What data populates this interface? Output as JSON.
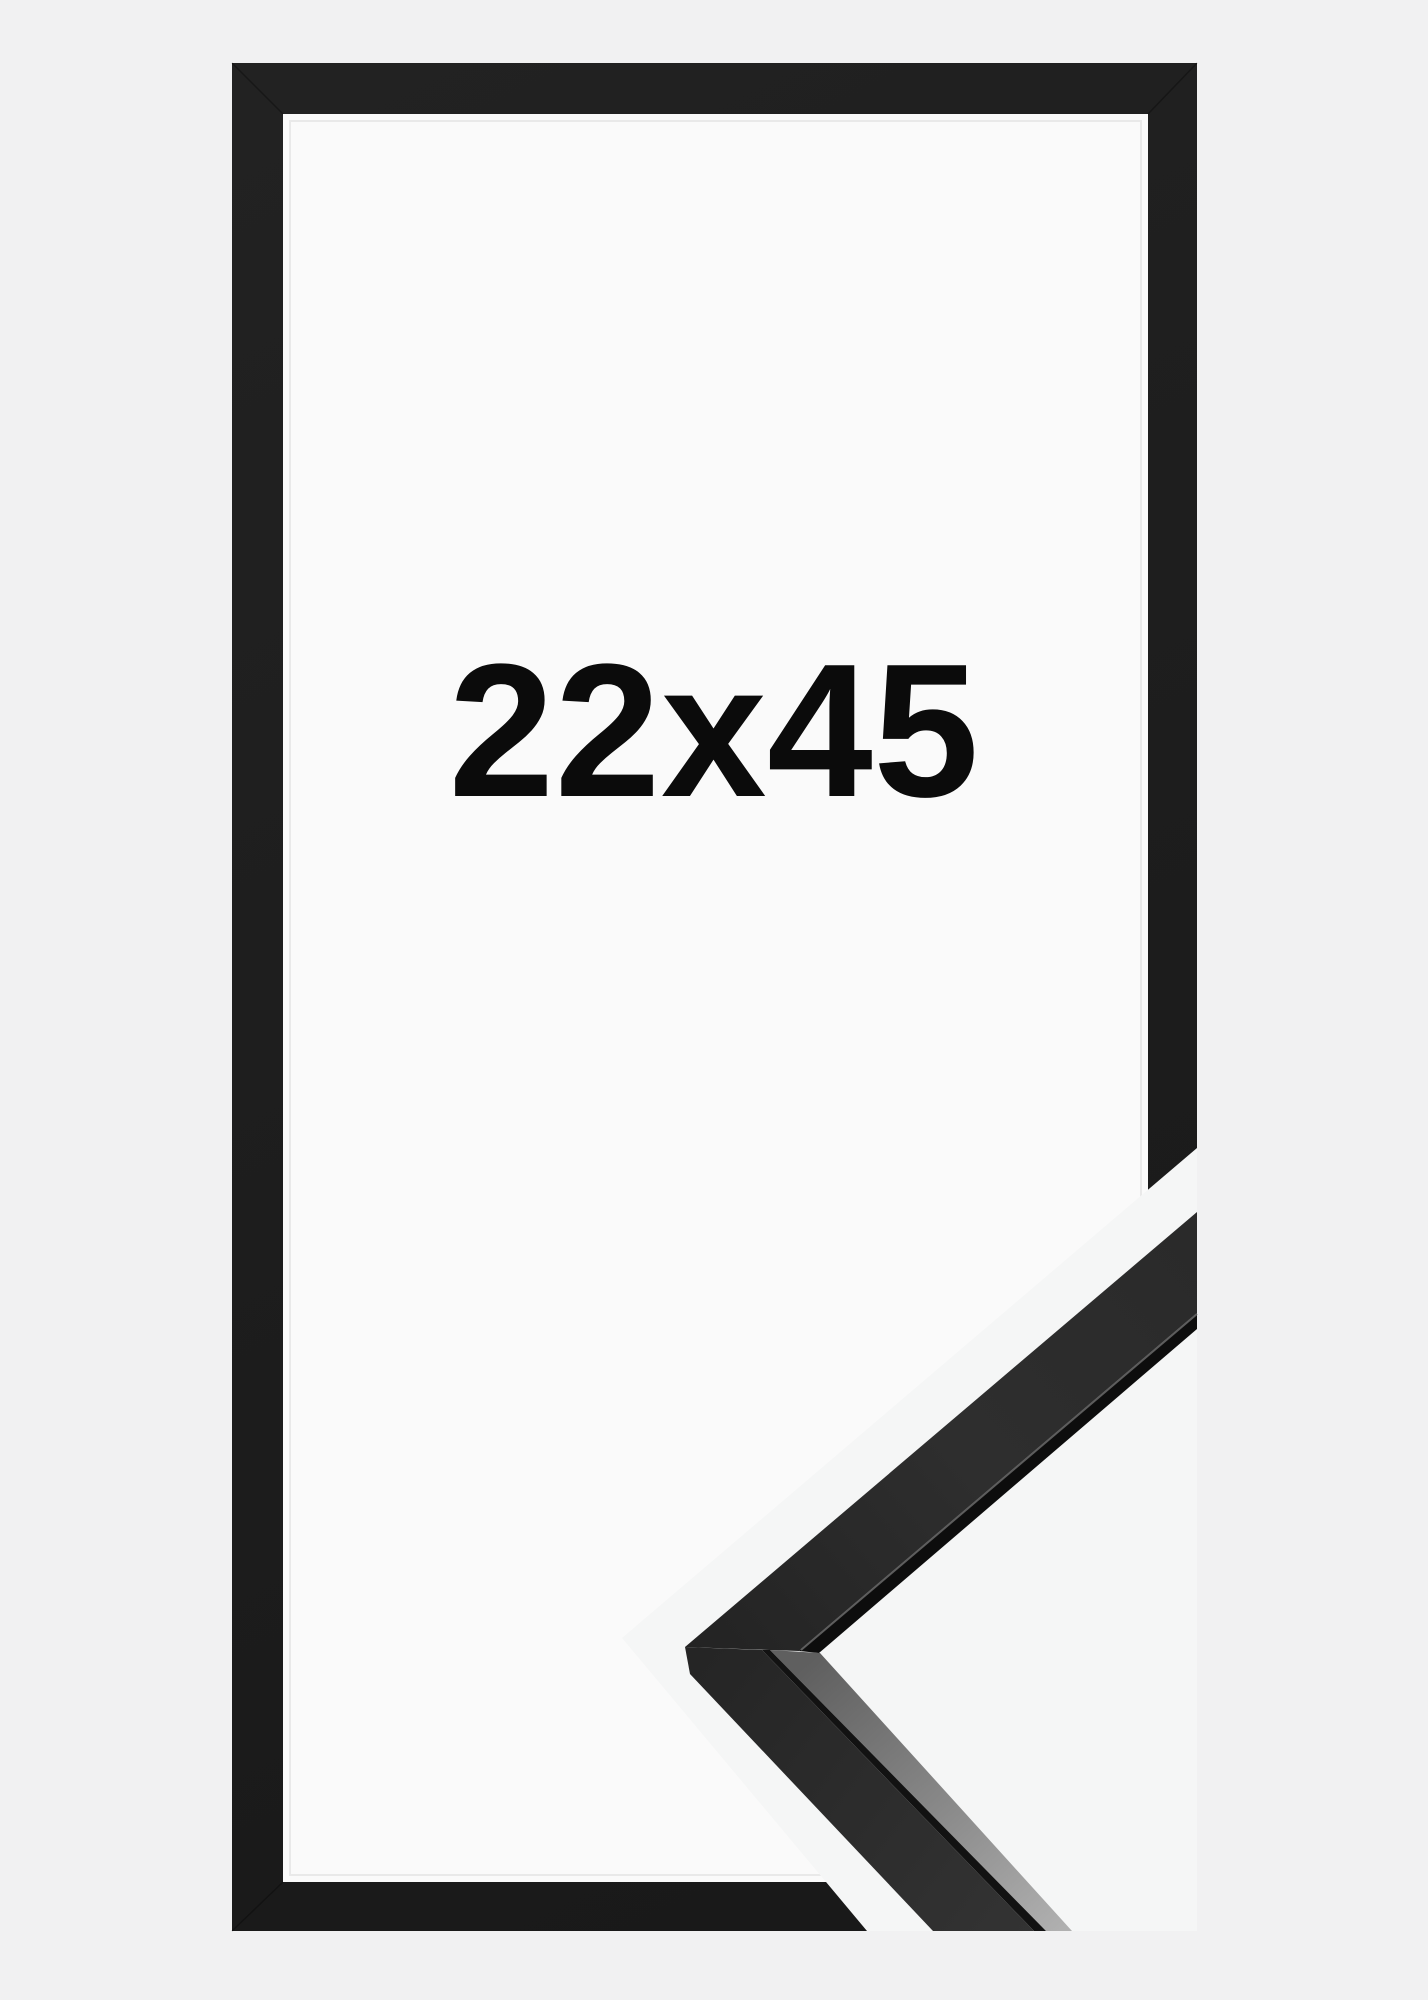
{
  "product_image": {
    "size_label": "22x45"
  },
  "colors": {
    "background": "#f1f1f2",
    "frame_black": "#1c1c1c",
    "matte_white": "#fafafa",
    "matte_seam": "#e9e9e9",
    "band_white": "#f5f6f6",
    "label_text": "#0b0b0b",
    "moulding_lip": "#0d0d0d",
    "moulding_groove": "#121212",
    "moulding_highlight": "#6a6a6a",
    "mitre_line": "#000000"
  }
}
